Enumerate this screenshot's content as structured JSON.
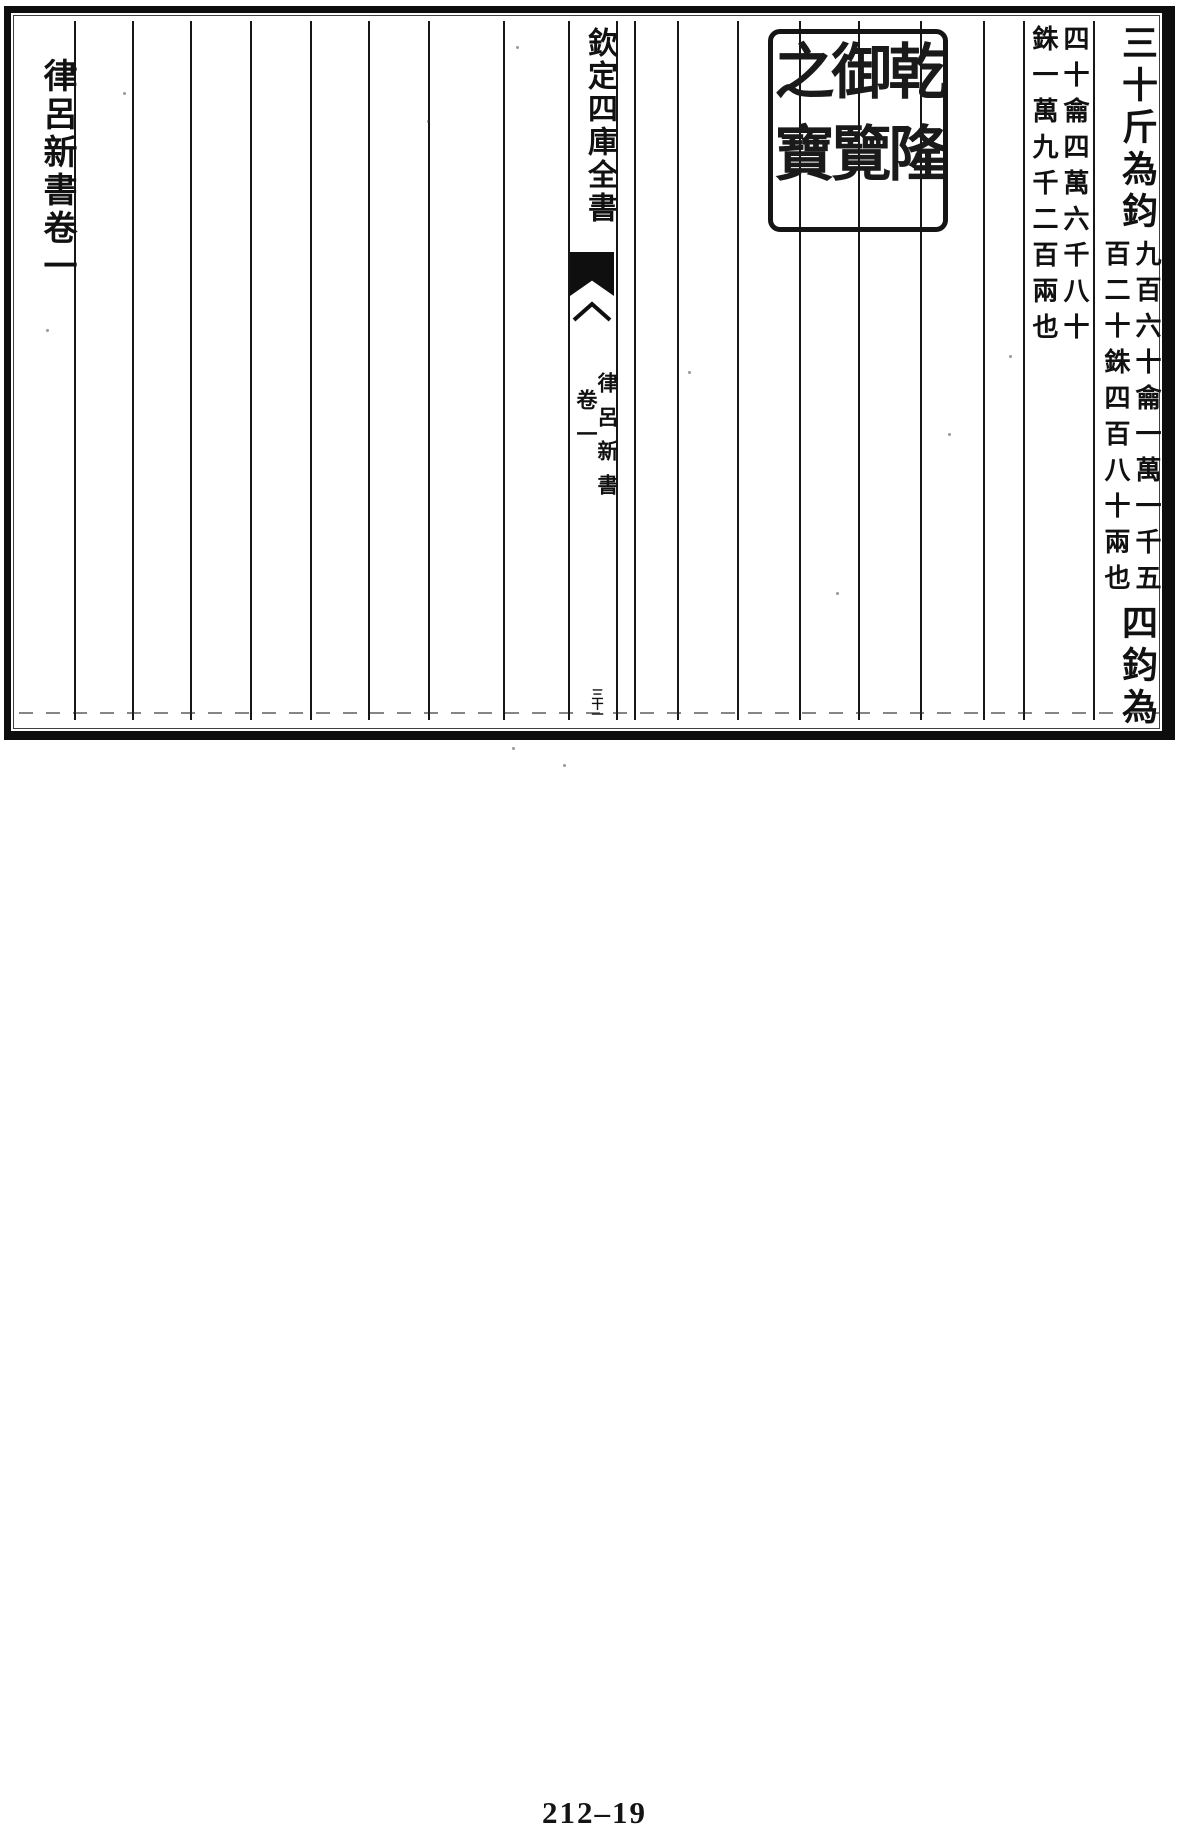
{
  "content": {
    "right_page": {
      "column_1": {
        "heading_top": "三十斤為鈞",
        "note_right": "九百六十龠一萬一千五",
        "note_left": "百二十銖四百八十兩也",
        "heading_bottom": "四鈞為石"
      },
      "column_2": {
        "note_right": "四十龠四萬六千八十",
        "note_left": "銖一萬九千二百兩也"
      },
      "seal": {
        "text": "乾隆御覽之寶"
      }
    },
    "banxin": {
      "title": "欽定四庫全書",
      "book": "律呂新書",
      "volume": "卷一",
      "leaf": "三十一"
    },
    "left_page": {
      "heading": "律呂新書卷一"
    },
    "footer": {
      "page_number": "212–19"
    },
    "colors": {
      "ink": "#111111",
      "paper": "#ffffff"
    }
  }
}
